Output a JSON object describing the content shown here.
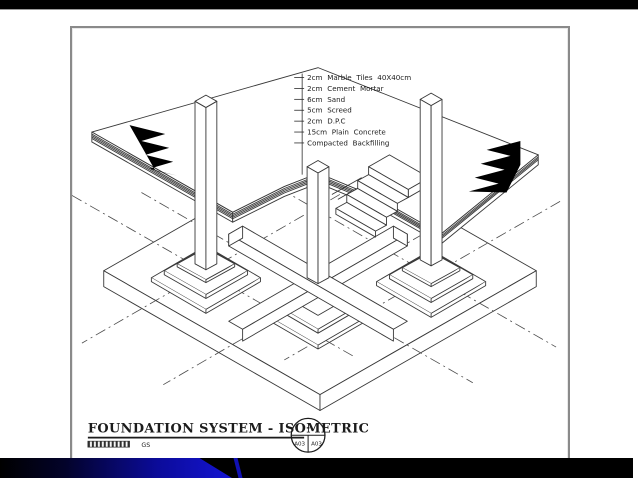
{
  "slide": {
    "background": "#ffffff",
    "top_bar_color": "#000000",
    "bottom_bar": {
      "base_color": "#000000",
      "accent_blue": "#1515d2",
      "deep_blue": "#0b0b9a"
    }
  },
  "drawing": {
    "type": "isometric-technical-drawing",
    "subject": "foundation system cutaway: raft base, stepped footings, ground beams, columns, floor layers, entrance steps",
    "line_color": "#383838",
    "hatch_color": "#000000",
    "layer_labels": [
      "2cm Marble Tiles 40X40cm",
      "2cm Cement Mortar",
      "6cm Sand",
      "5cm Screed",
      "2cm D.P.C",
      "15cm Plain Concrete",
      "Compacted Backfilling"
    ]
  },
  "title_block": {
    "title": "FOUNDATION SYSTEM - ISOMETRIC",
    "scale_label": "GS",
    "reference_circle": {
      "top": "-",
      "bottom_left": "A03",
      "bottom_right": "A03"
    }
  }
}
